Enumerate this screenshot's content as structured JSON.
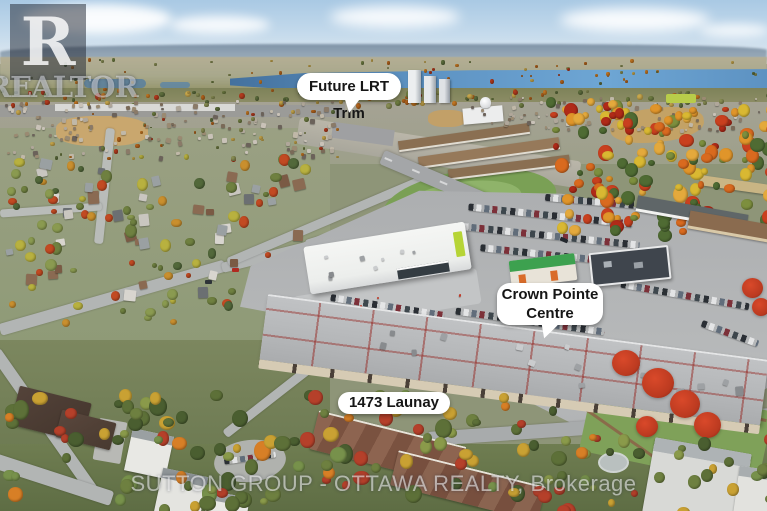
{
  "annotations": {
    "future_lrt": {
      "label": "Future LRT Trim"
    },
    "crown_pointe": {
      "line1": "Crown Pointe",
      "line2": "Centre"
    },
    "launay": {
      "label": "1473 Launay"
    }
  },
  "watermarks": {
    "realtor_letter": "R",
    "realtor_word": "REALTOR",
    "brokerage": "SUTTON GROUP - OTTAWA REALTY, Brokerage"
  },
  "colors": {
    "label-bg": "#ffffff",
    "label-text": "#161616",
    "river": "#5d92c2",
    "lime": "#b6d436",
    "resto-green": "#3da14f",
    "autumn-red": "#bb3a20"
  }
}
